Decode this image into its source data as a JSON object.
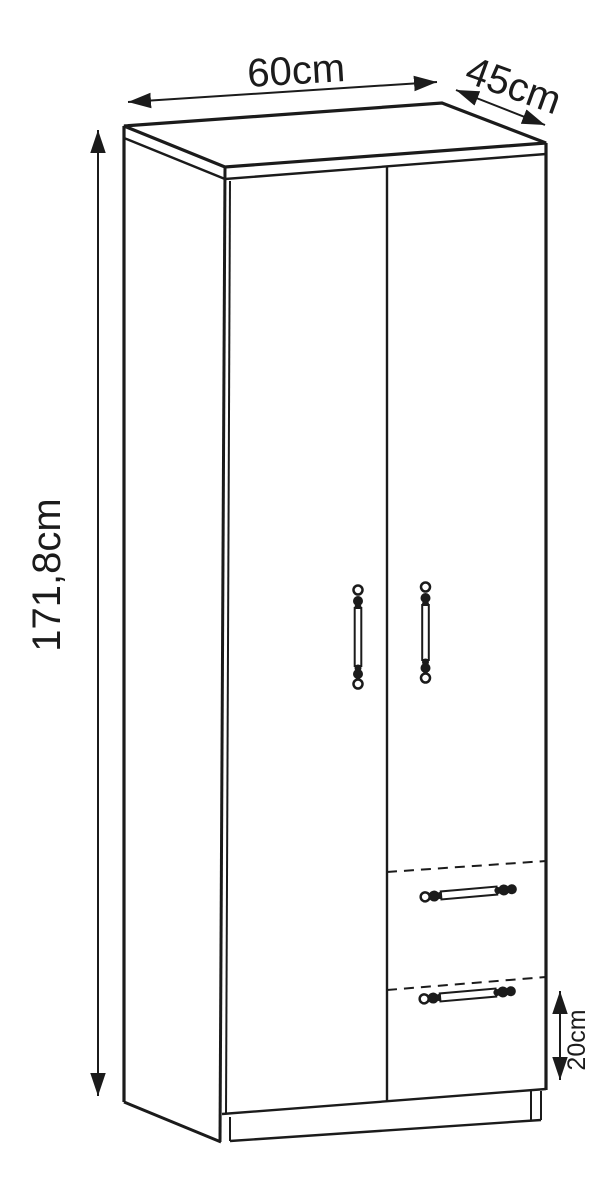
{
  "diagram": {
    "subject": "two-door-wardrobe-with-two-drawers-technical-drawing",
    "background_color": "#ffffff",
    "line_color": "#1b1b1b",
    "labels": {
      "width": "60cm",
      "depth": "45cm",
      "height": "171,8cm",
      "drawer_height": "20cm"
    }
  }
}
